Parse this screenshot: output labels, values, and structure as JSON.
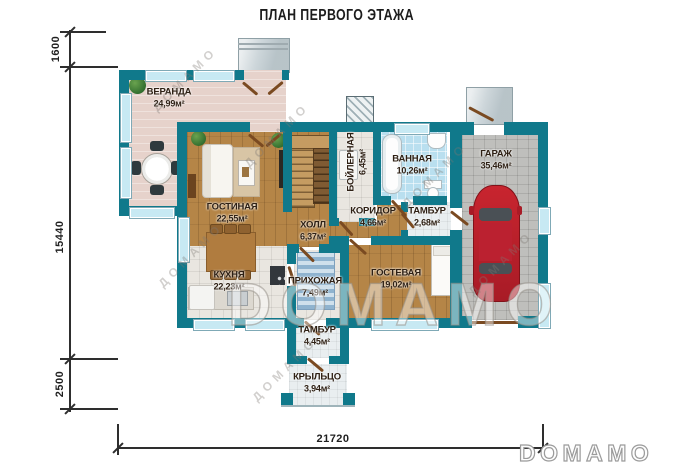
{
  "title": "ПЛАН ПЕРВОГО ЭТАЖА",
  "rooms": [
    {
      "name": "ВЕРАНДА",
      "area": "24,99м²"
    },
    {
      "name": "ГОСТИНАЯ",
      "area": "22,55м²"
    },
    {
      "name": "КУХНЯ",
      "area": "22,23м²"
    },
    {
      "name": "ХОЛЛ",
      "area": "6,37м²"
    },
    {
      "name": "БОЙЛЕРНАЯ",
      "area": "6,45м²"
    },
    {
      "name": "ВАННАЯ",
      "area": "10,26м²"
    },
    {
      "name": "КОРИДОР",
      "area": "4,66м²"
    },
    {
      "name": "ТАМБУР",
      "area": "2,68м²"
    },
    {
      "name": "ГАРАЖ",
      "area": "35,46м²"
    },
    {
      "name": "ПРИХОЖАЯ",
      "area": "7,49м²"
    },
    {
      "name": "ГОСТЕВАЯ",
      "area": "19,02м²"
    },
    {
      "name": "ТАМБУР",
      "area": "4,45м²"
    },
    {
      "name": "КРЫЛЬЦО",
      "area": "3,94м²"
    }
  ],
  "dimensions": {
    "left_top": "1600",
    "left_main": "15440",
    "left_bottom": "2500",
    "bottom_total": "21720"
  },
  "watermark": {
    "logo": "DOMAMO",
    "diagonal": "ДОМАМО"
  },
  "colors": {
    "wall_teal": "#10798b",
    "window_blue": "#c7e9f3",
    "wood_floor": "#b58547",
    "car_red": "#c2242f"
  }
}
